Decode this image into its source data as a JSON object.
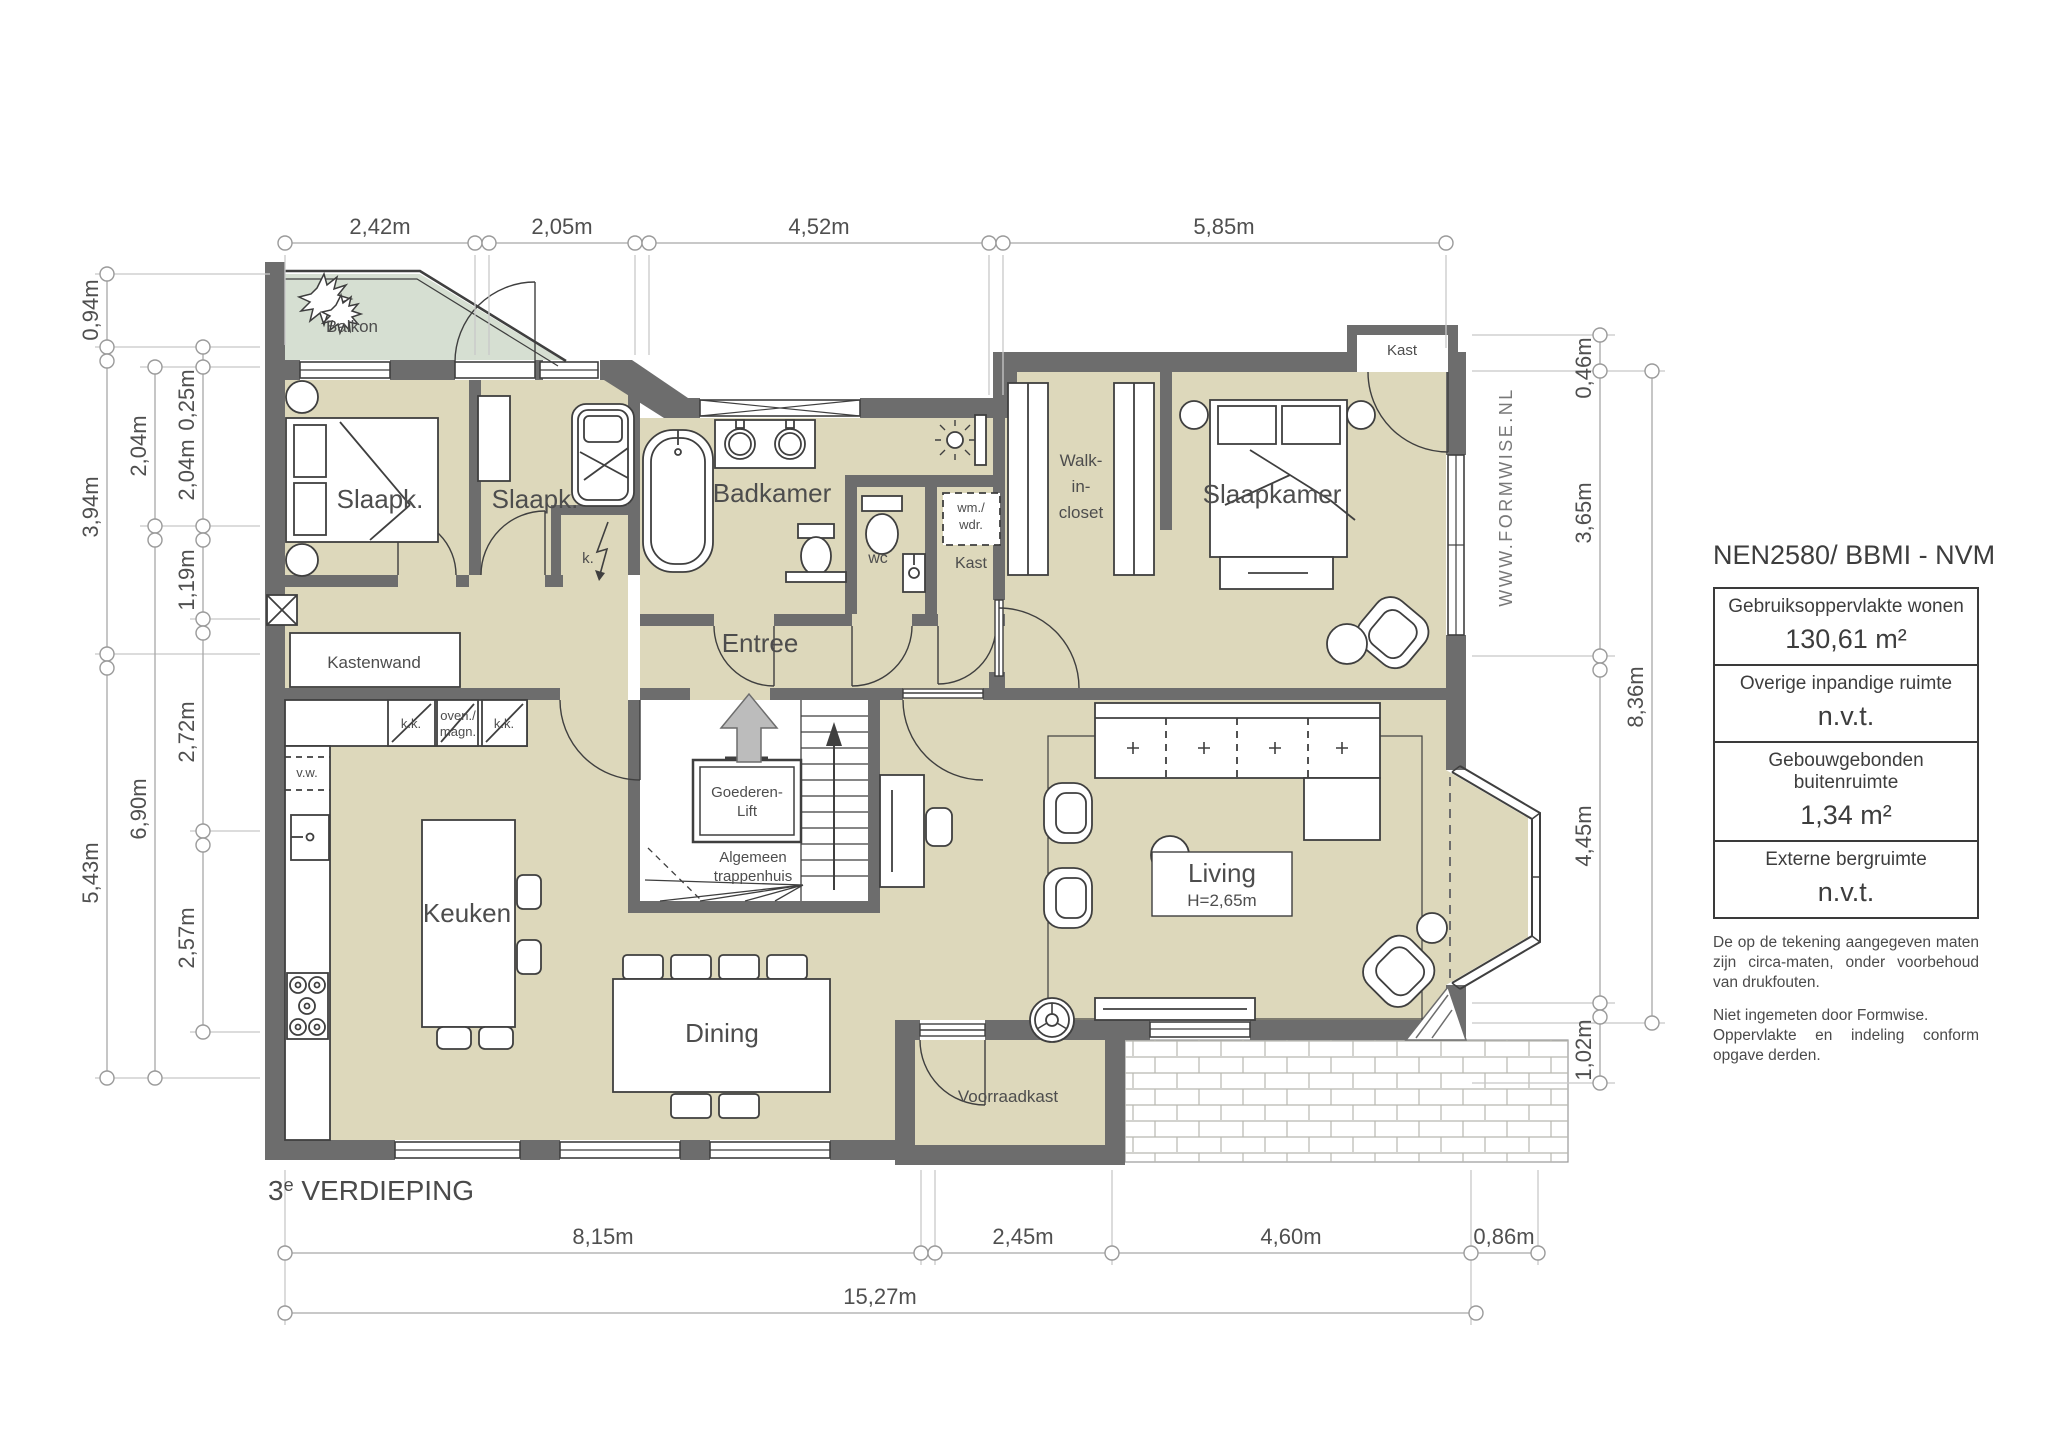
{
  "floor_label": {
    "number": "3",
    "suffix": "e",
    "name": " VERDIEPING"
  },
  "watermark": "WWW.FORMWISE.NL",
  "info_panel": {
    "title": "NEN2580/ BBMI - NVM",
    "rows": [
      {
        "label": "Gebruiksoppervlakte wonen",
        "value": "130,61 m²"
      },
      {
        "label": "Overige inpandige ruimte",
        "value": "n.v.t."
      },
      {
        "label": "Gebouwgebonden buitenruimte",
        "value": "1,34 m²"
      },
      {
        "label": "Externe bergruimte",
        "value": "n.v.t."
      }
    ],
    "disclaimer_1": "De op de tekening aangegeven maten zijn circa-maten, onder voorbehoud van drukfouten.",
    "disclaimer_2a": "Niet ingemeten door Formwise.",
    "disclaimer_2b": "Oppervlakte en indeling conform opgave derden."
  },
  "rooms": {
    "balkon": "Balkon",
    "slaapk_1": "Slaapk.",
    "slaapk_2": "Slaapk.",
    "badkamer": "Badkamer",
    "entree": "Entree",
    "wc": "wc",
    "kast_hal": "Kast",
    "kast_hoek": "Kast",
    "walk_in_closet": [
      "Walk-",
      "in-",
      "closet"
    ],
    "slaapkamer": "Slaapkamer",
    "kastenwand": "Kastenwand",
    "keuken": "Keuken",
    "goederen_lift": [
      "Goederen-",
      "Lift"
    ],
    "trappenhuis": [
      "Algemeen",
      "trappenhuis"
    ],
    "living": "Living",
    "living_height": "H=2,65m",
    "dining": "Dining",
    "voorraadkast": "Voorraadkast"
  },
  "fixtures": {
    "kk_1": "k.k.",
    "oven_1": "oven./",
    "oven_2": "magn.",
    "kk_2": "k.k.",
    "vw": "v.w.",
    "wm_1": "wm./",
    "wm_2": "wdr.",
    "k": "k."
  },
  "dimensions": {
    "top": [
      "2,42m",
      "2,05m",
      "4,52m",
      "5,85m"
    ],
    "bottom": [
      "8,15m",
      "2,45m",
      "4,60m",
      "0,86m"
    ],
    "bottom_total": "15,27m",
    "left_outer": [
      "0,94m",
      "3,94m",
      "5,43m"
    ],
    "left_middle": [
      "2,04m",
      "6,90m"
    ],
    "left_inner": [
      "0,25m",
      "2,04m",
      "1,19m",
      "2,72m",
      "2,57m"
    ],
    "right_inner": [
      "0,46m",
      "3,65m",
      "4,45m",
      "1,02m"
    ],
    "right_outer": "8,36m"
  },
  "colors": {
    "wall": "#6d6d6d",
    "floor": "#ddd8bb",
    "balcony": "#d6dfd2",
    "furniture_line": "#3f3f3f",
    "dimension_line": "#a0a0a0",
    "text": "#4d4d4d"
  }
}
